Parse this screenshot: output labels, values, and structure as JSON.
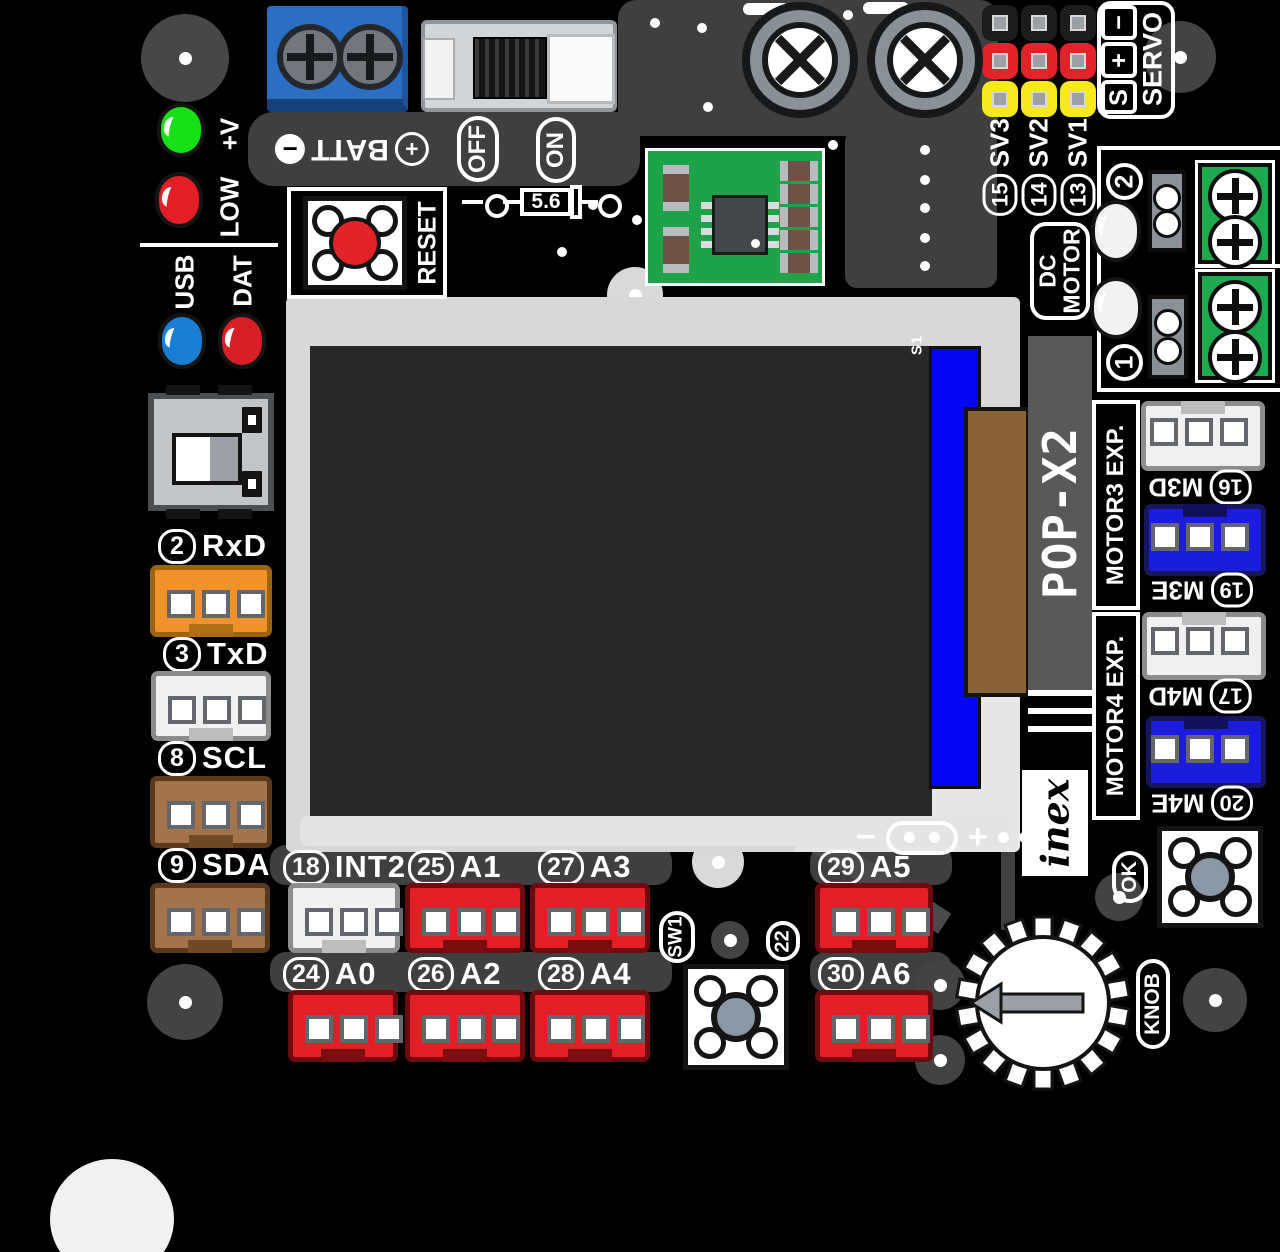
{
  "board": {
    "model": "POP-X2",
    "vendor": "inex",
    "lcd_marking": "S1",
    "lcd_minus": "−",
    "lcd_plus": "+"
  },
  "power": {
    "batt": "BATT",
    "plus": "+",
    "minus": "−",
    "off": "OFF",
    "on": "ON",
    "reset": "RESET",
    "diode_value": "5.6",
    "led_power": "+V",
    "led_low": "LOW"
  },
  "comm": {
    "usb": "USB",
    "dat": "DAT"
  },
  "left_ports": [
    {
      "num": "2",
      "name": "RxD"
    },
    {
      "num": "3",
      "name": "TxD"
    },
    {
      "num": "8",
      "name": "SCL"
    },
    {
      "num": "9",
      "name": "SDA"
    }
  ],
  "servo": {
    "title": "SERVO",
    "pin_minus": "−",
    "pin_plus": "+",
    "pin_signal": "S",
    "channels": [
      {
        "num": "15",
        "name": "SV3"
      },
      {
        "num": "14",
        "name": "SV2"
      },
      {
        "num": "13",
        "name": "SV1"
      }
    ]
  },
  "dc_motor": {
    "line1": "DC",
    "line2": "MOTOR",
    "channel2": "2",
    "channel1": "1"
  },
  "motor_exp": {
    "m3_title": "MOTOR3 EXP.",
    "m3_ports": [
      {
        "num": "16",
        "name": "M3D"
      },
      {
        "num": "19",
        "name": "M3E"
      }
    ],
    "m4_title": "MOTOR4 EXP.",
    "m4_ports": [
      {
        "num": "17",
        "name": "M4D"
      },
      {
        "num": "20",
        "name": "M4E"
      }
    ]
  },
  "bottom_ports": {
    "row1": [
      {
        "num": "18",
        "name": "INT2"
      },
      {
        "num": "25",
        "name": "A1"
      },
      {
        "num": "27",
        "name": "A3"
      },
      {
        "num": "29",
        "name": "A5"
      }
    ],
    "row2": [
      {
        "num": "24",
        "name": "A0"
      },
      {
        "num": "26",
        "name": "A2"
      },
      {
        "num": "28",
        "name": "A4"
      },
      {
        "num": "30",
        "name": "A6"
      }
    ]
  },
  "controls": {
    "sw1": "SW1",
    "sw1_num": "22",
    "ok": "OK",
    "knob": "KNOB"
  },
  "colors": {
    "port_red": "#e31e26",
    "port_orange": "#f0912b",
    "port_brown": "#a3734b",
    "port_white": "#f0f0f0",
    "port_blue": "#1c1cdc",
    "terminal_green": "#1fa94e",
    "batt_blue": "#2a6fc4",
    "lcd_blue": "#0505f5",
    "servo_yellow": "#f6e81c",
    "board_silk": "#ffffff"
  }
}
